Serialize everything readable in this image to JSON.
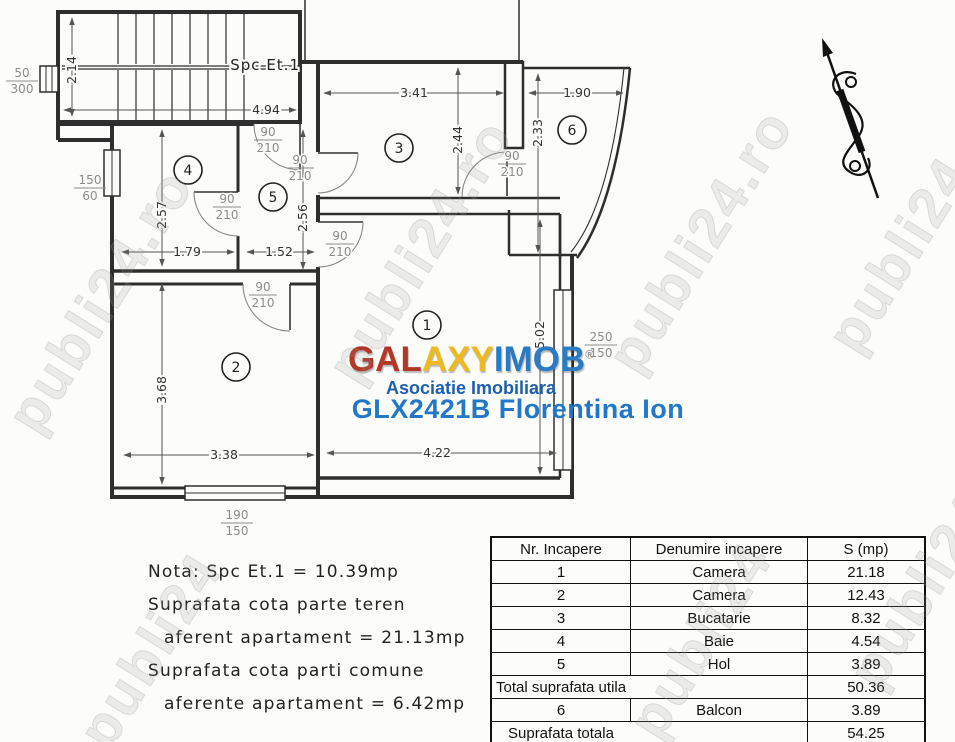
{
  "watermark": {
    "text": "publi24.ro",
    "short": "publi24"
  },
  "plan": {
    "stair_label": "Spc Et.1",
    "rooms": [
      "1",
      "2",
      "3",
      "4",
      "5",
      "6"
    ],
    "door": {
      "top": "90",
      "bottom": "210"
    },
    "windows": {
      "stair": {
        "top": "50",
        "bottom": "300"
      },
      "left": {
        "top": "150",
        "bottom": "60"
      },
      "bottom": {
        "top": "190",
        "bottom": "150"
      },
      "right": {
        "top": "250",
        "bottom": "150"
      }
    },
    "dims": {
      "stair_h": "2.14",
      "stair_w": "4.94",
      "room3_w": "3.41",
      "balcon_w": "1.90",
      "room3_h": "2.44",
      "balcon_h": "2.33",
      "baie_h": "2.57",
      "baie_w": "1.79",
      "hol_w": "1.52",
      "hol_h": "2.56",
      "room2_h": "3.68",
      "room2_w": "3.38",
      "room1_w": "4.22",
      "room1_h": "5.02"
    }
  },
  "branding": {
    "logo_part1": "GAL",
    "logo_part2": "AXY",
    "logo_part3": "IMOB",
    "registered": "®",
    "subtitle": "Asociatie Imobiliara",
    "listing": "GLX2421B Florentina Ion",
    "colors": {
      "red": "#b23726",
      "gold": "#edb91f",
      "blue": "#2b7bc4",
      "subtitle_blue": "#1b5fb0",
      "listing_blue": "#2277c8"
    }
  },
  "notes": {
    "lines": [
      "Nota: Spc Et.1 = 10.39mp",
      "Suprafata cota parte teren",
      "aferent apartament = 21.13mp",
      "Suprafata cota parti comune",
      "aferente apartament = 6.42mp"
    ]
  },
  "table": {
    "headers": [
      "Nr. Incapere",
      "Denumire incapere",
      "S (mp)"
    ],
    "rows": [
      [
        "1",
        "Camera",
        "21.18"
      ],
      [
        "2",
        "Camera",
        "12.43"
      ],
      [
        "3",
        "Bucatarie",
        "8.32"
      ],
      [
        "4",
        "Baie",
        "4.54"
      ],
      [
        "5",
        "Hol",
        "3.89"
      ]
    ],
    "total_utila_label": "Total suprafata utila",
    "total_utila_value": "50.36",
    "balcon_row": [
      "6",
      "Balcon",
      "3.89"
    ],
    "total_label": "Suprafata totala",
    "total_value": "54.25"
  }
}
